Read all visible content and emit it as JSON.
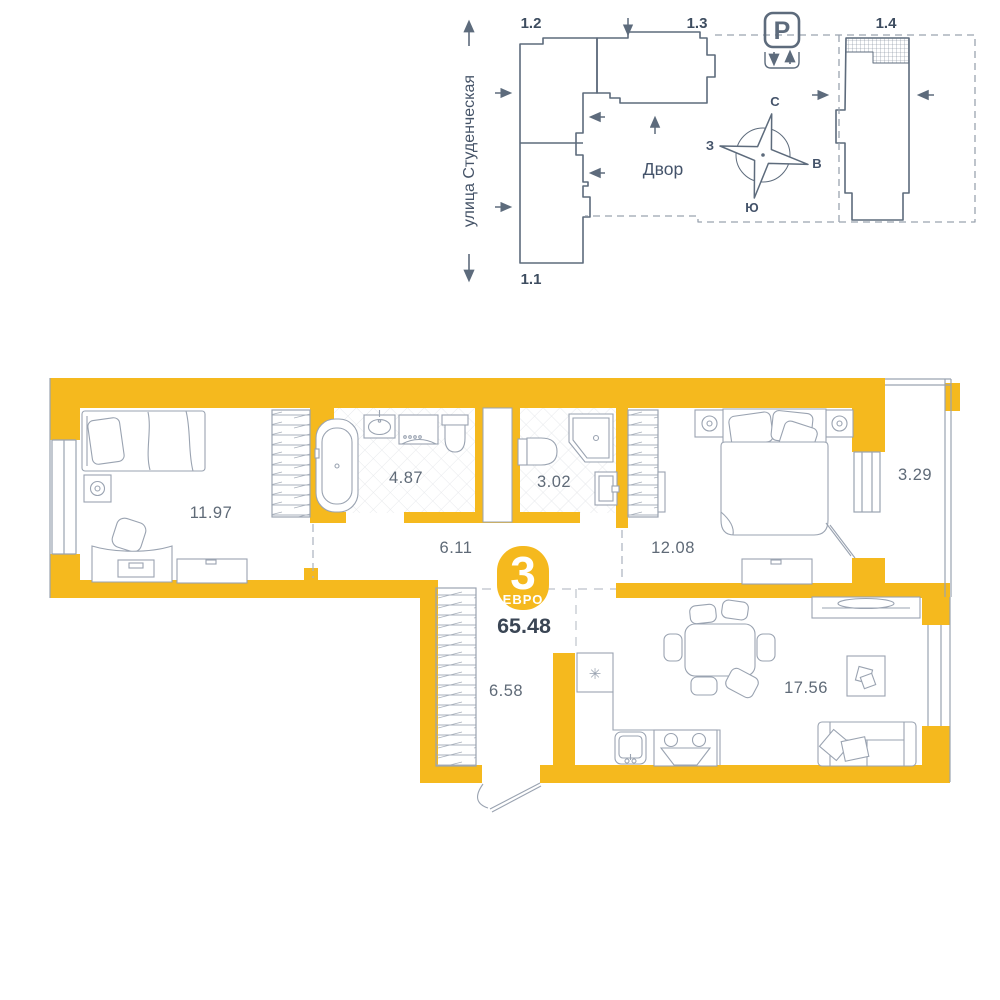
{
  "site_plan": {
    "street_label": "улица Студенческая",
    "courtyard_label": "Двор",
    "parking_label": "P",
    "compass": {
      "north": "С",
      "south": "Ю",
      "west": "З",
      "east": "В"
    },
    "buildings": {
      "b1_1": "1.1",
      "b1_2": "1.2",
      "b1_3": "1.3",
      "b1_4": "1.4"
    }
  },
  "floor_plan": {
    "badge": {
      "rooms_count": "3",
      "plan_type": "ЕВРО"
    },
    "total_area": "65.48",
    "areas": {
      "bedroom_1": "11.97",
      "bathroom": "4.87",
      "wc": "3.02",
      "hallway": "6.11",
      "bedroom_2": "12.08",
      "balcony": "3.29",
      "corridor": "6.58",
      "kitchen_living": "17.56"
    },
    "fridge_icon": "✳"
  },
  "colors": {
    "accent": "#F5B91E",
    "site_line": "#5D6B7C",
    "furniture_line": "#9AA3B1",
    "text_dark": "#3A4554",
    "text_area": "#5F6A77"
  }
}
